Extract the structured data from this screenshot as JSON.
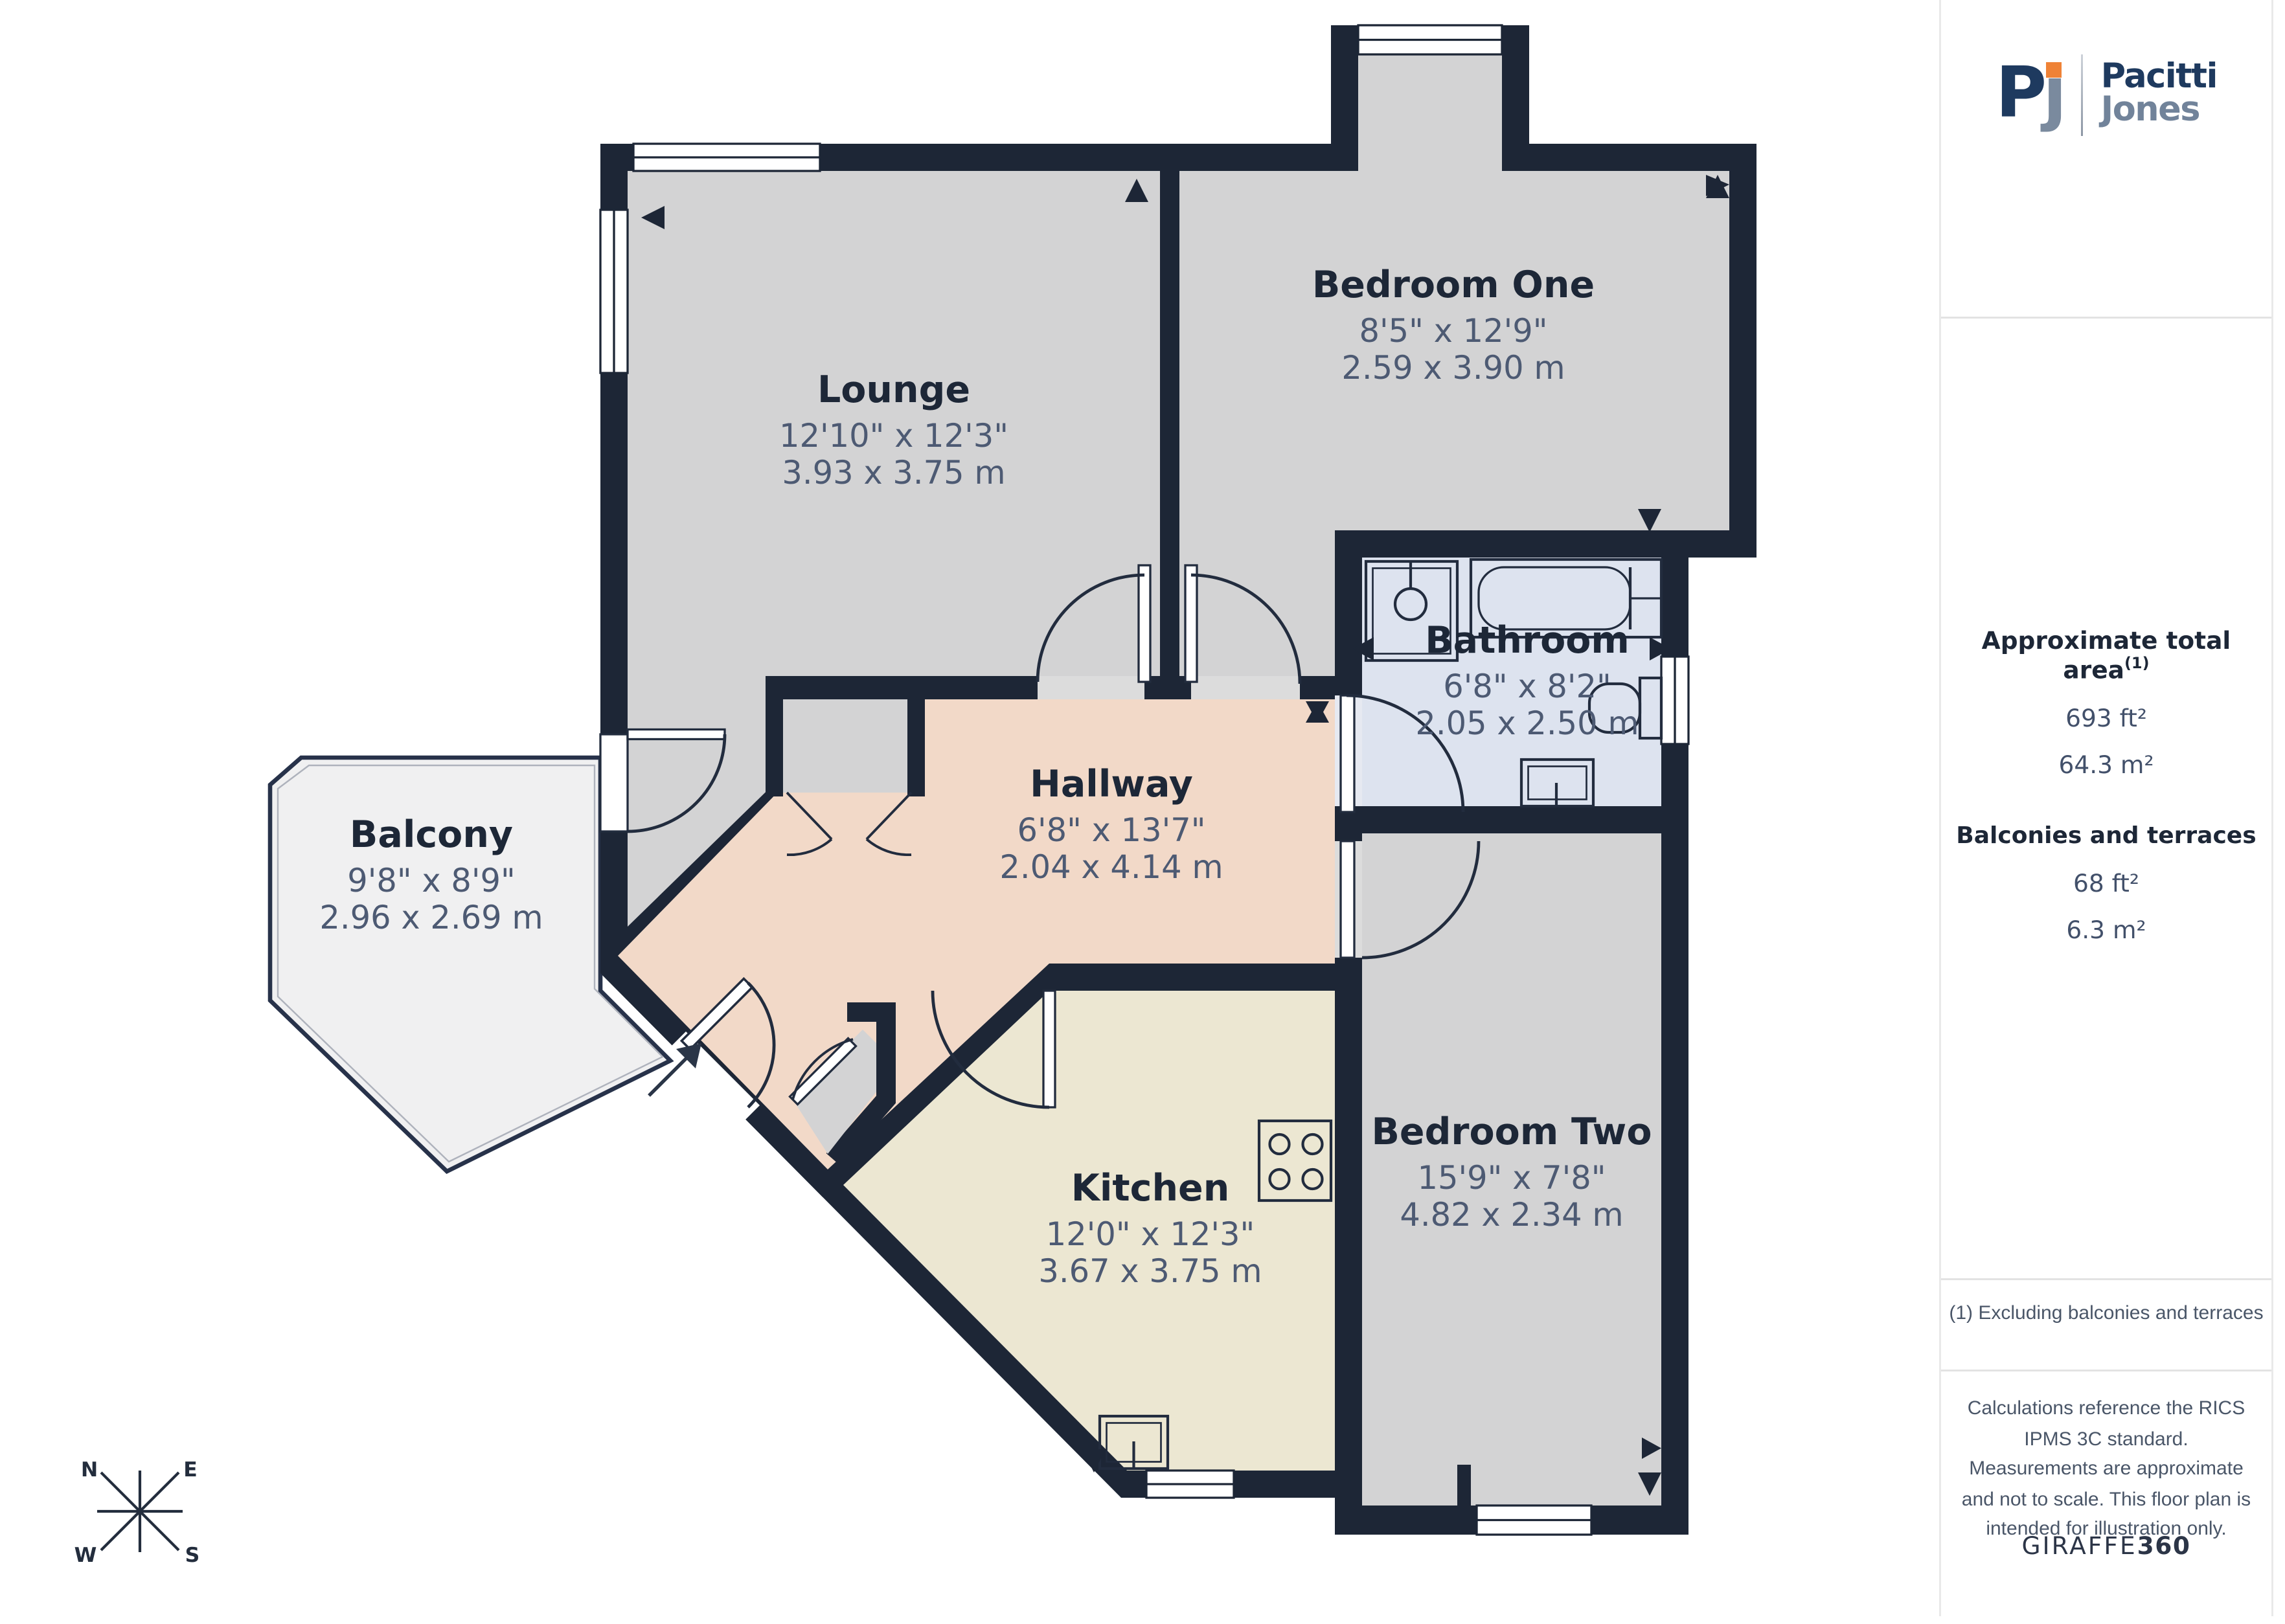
{
  "branding": {
    "monogram_p": "P",
    "monogram_j": "ȷ",
    "name_line1": "Pacitti",
    "name_line2": "Jones"
  },
  "sidebar": {
    "total_area_label": "Approximate total area",
    "total_area_sup": "(1)",
    "total_area_ft": "693 ft²",
    "total_area_m": "64.3 m²",
    "balconies_label": "Balconies and terraces",
    "balconies_ft": "68 ft²",
    "balconies_m": "6.3 m²",
    "footnote": "(1) Excluding balconies and terraces",
    "disclaimer": "Calculations reference the RICS IPMS 3C standard. Measurements are approximate and not to scale. This floor plan is intended for illustration only.",
    "credit_normal": "GIRAFFE",
    "credit_bold": "360"
  },
  "compass": {
    "n": "N",
    "e": "E",
    "s": "S",
    "w": "W"
  },
  "rooms": [
    {
      "name": "Lounge",
      "imperial": "12'10\" x 12'3\"",
      "metric": "3.93 x 3.75 m"
    },
    {
      "name": "Bedroom One",
      "imperial": "8'5\" x 12'9\"",
      "metric": "2.59 x 3.90 m"
    },
    {
      "name": "Bathroom",
      "imperial": "6'8\" x 8'2\"",
      "metric": "2.05 x 2.50 m"
    },
    {
      "name": "Hallway",
      "imperial": "6'8\" x 13'7\"",
      "metric": "2.04 x 4.14 m"
    },
    {
      "name": "Kitchen",
      "imperial": "12'0\" x 12'3\"",
      "metric": "3.67 x 3.75 m"
    },
    {
      "name": "Bedroom Two",
      "imperial": "15'9\" x 7'8\"",
      "metric": "4.82 x 2.34 m"
    },
    {
      "name": "Balcony",
      "imperial": "9'8\" x 8'9\"",
      "metric": "2.96 x 2.69 m"
    }
  ],
  "colors": {
    "wall": "#1d2636",
    "room_gray": "#d3d3d4",
    "bathroom_blue": "#dde3ef",
    "hallway_pink": "#f2d9c8",
    "kitchen_cream": "#ece7d2",
    "balcony_gray": "#f0f0f1",
    "accent_orange": "#ef8236",
    "brand_navy": "#1e3a5f",
    "brand_slate": "#71839a"
  }
}
